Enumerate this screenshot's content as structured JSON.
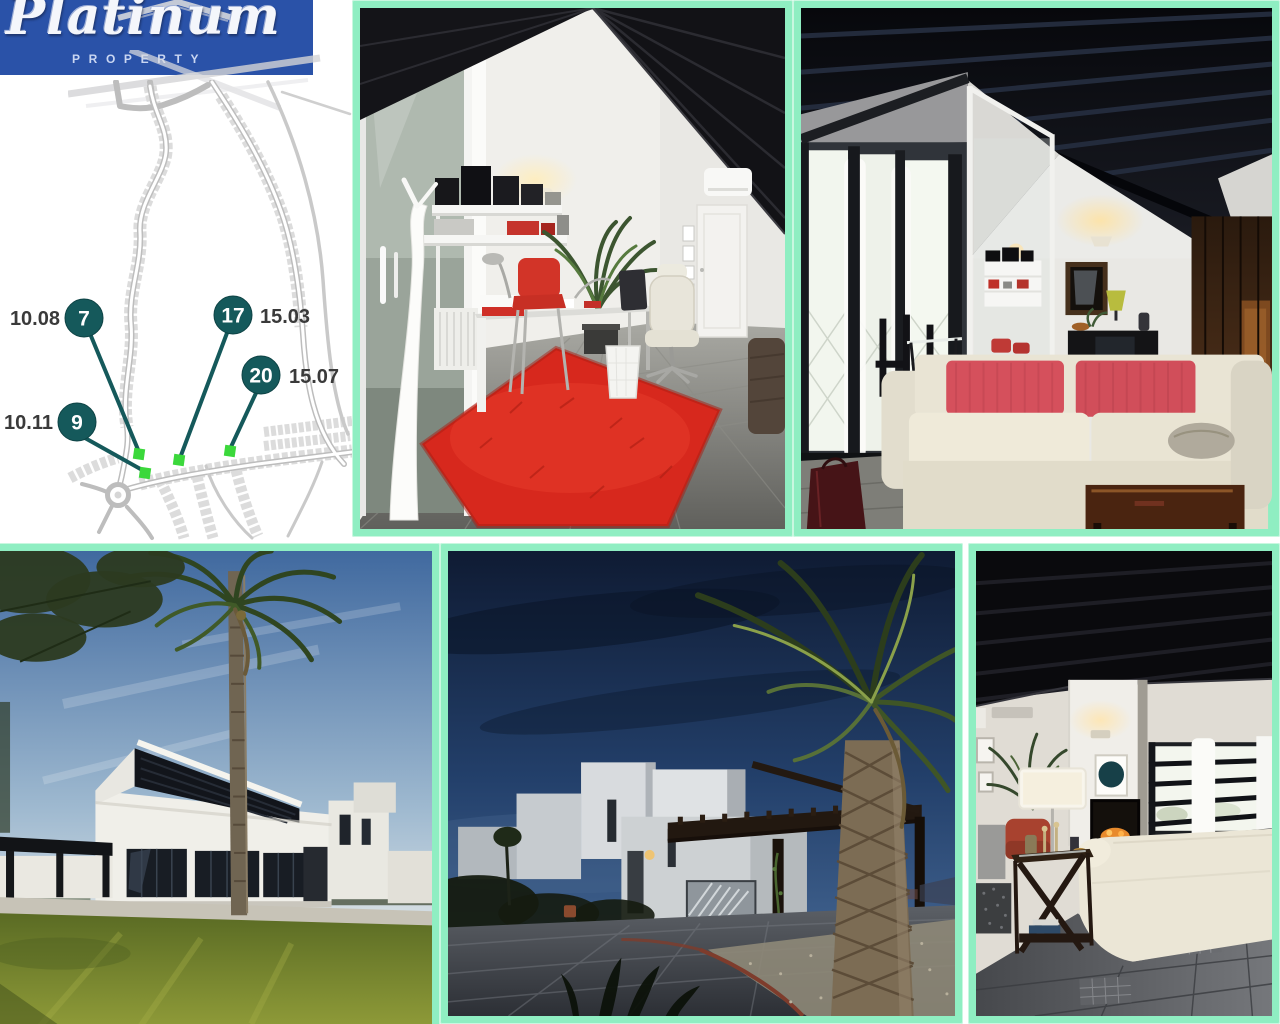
{
  "page": {
    "background": "#ffffff",
    "frame_color": "#8feec2"
  },
  "logo": {
    "brand": "Platinum",
    "subtitle": "PROPERTY",
    "bg_color": "#2a52a8"
  },
  "site_plan": {
    "description": "Development site plan with numbered plots and highlighted locations",
    "plot_circle_color": "#15595b",
    "plot_marker_color": "#3bd83b",
    "road_color": "#c2c2c2",
    "plots": [
      {
        "number": "7",
        "ref": "10.08"
      },
      {
        "number": "9",
        "ref": "10.11"
      },
      {
        "number": "17",
        "ref": "15.03"
      },
      {
        "number": "20",
        "ref": "15.07"
      }
    ]
  },
  "photos": [
    {
      "id": "office-interior",
      "alt": "Home office with sloped black beamed ceiling, white desk, red chair and red rug"
    },
    {
      "id": "living-room-red-cushions",
      "alt": "Living room with dark beamed cathedral ceiling, cream sofa with red cushions and window wall"
    },
    {
      "id": "villa-garden",
      "alt": "Modern white villa exterior with palm tree, pergola and green lawn"
    },
    {
      "id": "villa-carport",
      "alt": "Modern white villa at dusk with wooden pergola carport, palm tree and paved driveway"
    },
    {
      "id": "living-room-lamp",
      "alt": "Living room with dark beamed ceiling, floor lamp, fireplace and cream sofa"
    }
  ]
}
